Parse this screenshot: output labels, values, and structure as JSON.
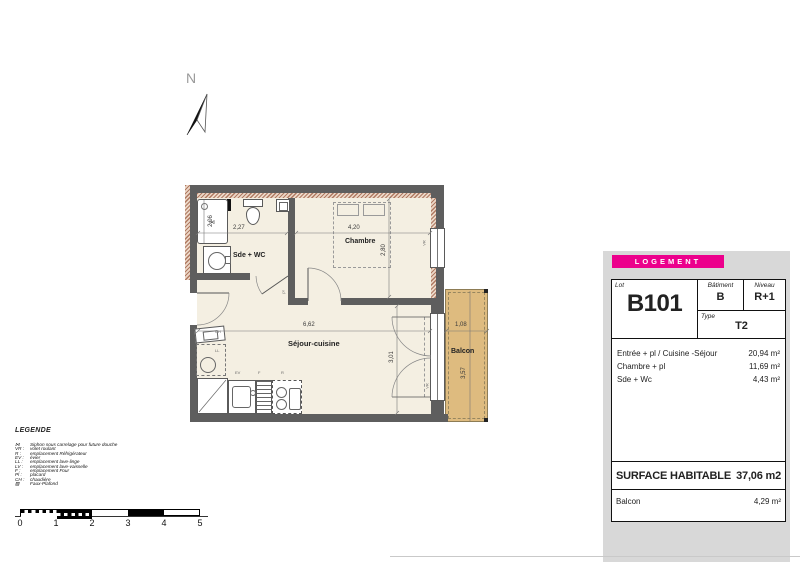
{
  "colors": {
    "accent_magenta": "#ec008c",
    "wall_gray": "#5e5e5e",
    "floor_cream": "#f4efe2",
    "balcony_tan": "#debb7f",
    "insulation_hatch": "#b07a62",
    "panel_bg": "#d8d8d8"
  },
  "plan": {
    "north_label": "N",
    "sde_wc_label": "Sde + WC",
    "chambre_label": "Chambre",
    "sejour_label": "Séjour-cuisine",
    "balcon_label": "Balcon",
    "dims": {
      "shower_h": "2,06",
      "sde_w": "2,27",
      "chambre_w": "4,20",
      "chambre_h": "2,80",
      "sejour_w": "6,62",
      "sejour_h": "3,01",
      "balcon_w": "1,08",
      "balcon_h": "3,57"
    },
    "tags": {
      "vr": "VR",
      "pl": "pl",
      "ev": "EV",
      "four": "F",
      "refrigerateur": "R",
      "chaudiere": "CH",
      "lave_linge": "LL"
    }
  },
  "legend": {
    "title": "LEGENDE",
    "items": [
      {
        "a": "⋈",
        "t": "Siphon sous carrelage pour future douche"
      },
      {
        "a": "VR :",
        "t": "volet roulant"
      },
      {
        "a": "R :",
        "t": "emplacement Réfrigérateur"
      },
      {
        "a": "EV :",
        "t": "évier"
      },
      {
        "a": "LL :",
        "t": "emplacement lave-linge"
      },
      {
        "a": "LV :",
        "t": "emplacement lave-vaisselle"
      },
      {
        "a": "F :",
        "t": "emplacement Four"
      },
      {
        "a": "Pl :",
        "t": "placard"
      },
      {
        "a": "CH :",
        "t": "chaudière"
      },
      {
        "a": "▨",
        "t": "Faux-Plafond"
      }
    ]
  },
  "scalebar": {
    "ticks": [
      "0",
      "1",
      "2",
      "3",
      "4",
      "5"
    ]
  },
  "panel": {
    "header": "LOGEMENT",
    "lot_label": "Lot",
    "lot": "B101",
    "batiment_label": "Bâtiment",
    "batiment": "B",
    "niveau_label": "Niveau",
    "niveau": "R+1",
    "type_label": "Type",
    "type": "T2",
    "surfaces": [
      {
        "name": "Entrée + pl / Cuisine -Séjour",
        "value": "20,94 m²"
      },
      {
        "name": "Chambre + pl",
        "value": "11,69 m²"
      },
      {
        "name": "Sde + Wc",
        "value": "4,43 m²"
      }
    ],
    "total_label": "SURFACE HABITABLE",
    "total_value": "37,06 m2",
    "balcon_label": "Balcon",
    "balcon_value": "4,29 m²"
  }
}
